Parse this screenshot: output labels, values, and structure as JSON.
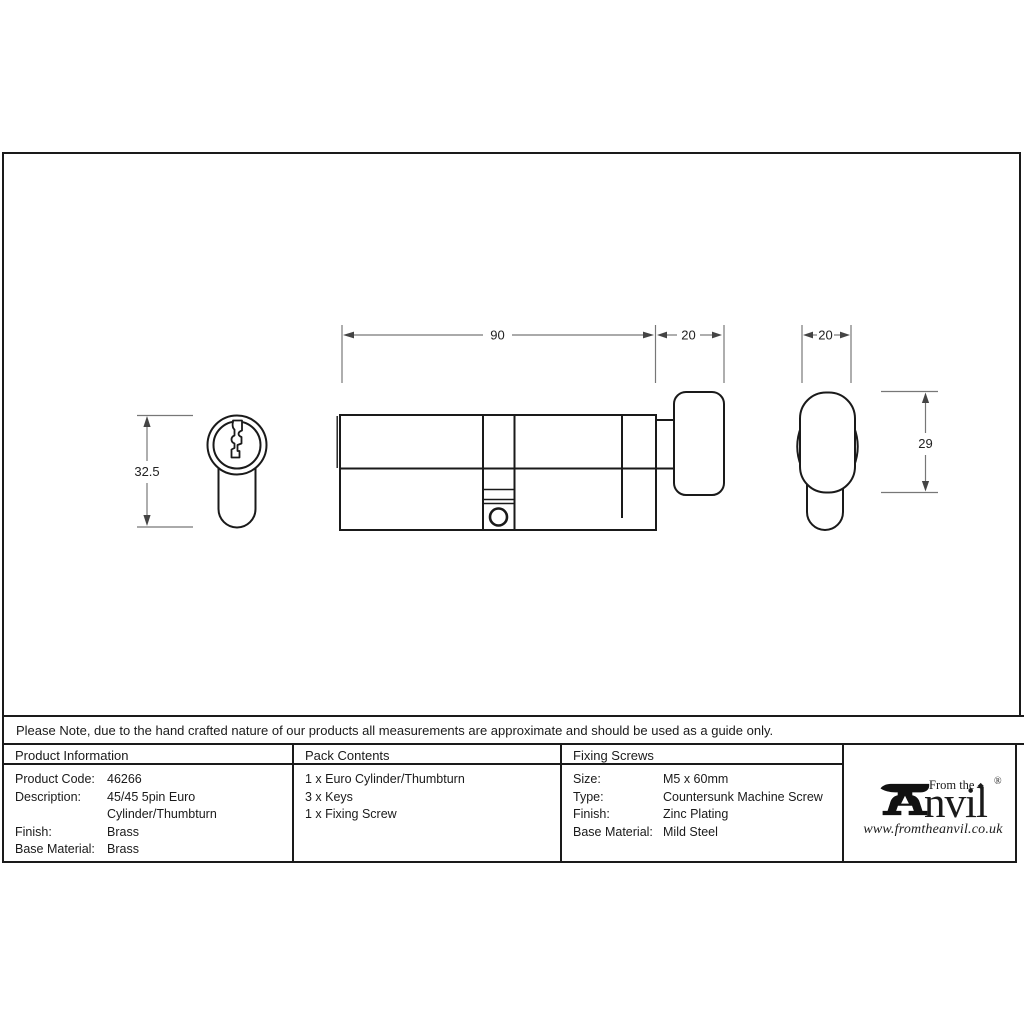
{
  "note": "Please Note, due to the hand crafted nature of our products all measurements are approximate and should be used as a guide only.",
  "drawing": {
    "dims": {
      "profile_height": "32.5",
      "body_length": "90",
      "turn_length": "20",
      "turn_width": "20",
      "turn_height": "29"
    }
  },
  "table": {
    "product_information": {
      "header": "Product Information",
      "rows": [
        {
          "label": "Product Code:",
          "value": "46266"
        },
        {
          "label": "Description:",
          "value": "45/45 5pin Euro Cylinder/Thumbturn"
        },
        {
          "label": "Finish:",
          "value": "Brass"
        },
        {
          "label": "Base Material:",
          "value": "Brass"
        }
      ]
    },
    "pack_contents": {
      "header": "Pack Contents",
      "items": [
        "1 x Euro Cylinder/Thumbturn",
        "3 x Keys",
        "1 x Fixing Screw"
      ]
    },
    "fixing_screws": {
      "header": "Fixing Screws",
      "rows": [
        {
          "label": "Size:",
          "value": "M5 x 60mm"
        },
        {
          "label": "Type:",
          "value": "Countersunk Machine Screw"
        },
        {
          "label": "Finish:",
          "value": "Zinc Plating"
        },
        {
          "label": "Base Material:",
          "value": "Mild Steel"
        }
      ]
    }
  },
  "logo": {
    "tagline": "From the",
    "diamond": "◆",
    "wordmark": "nvil",
    "registered": "®",
    "url": "www.fromtheanvil.co.uk"
  },
  "colors": {
    "line": "#1a1a1a",
    "dim_line": "#777777"
  }
}
